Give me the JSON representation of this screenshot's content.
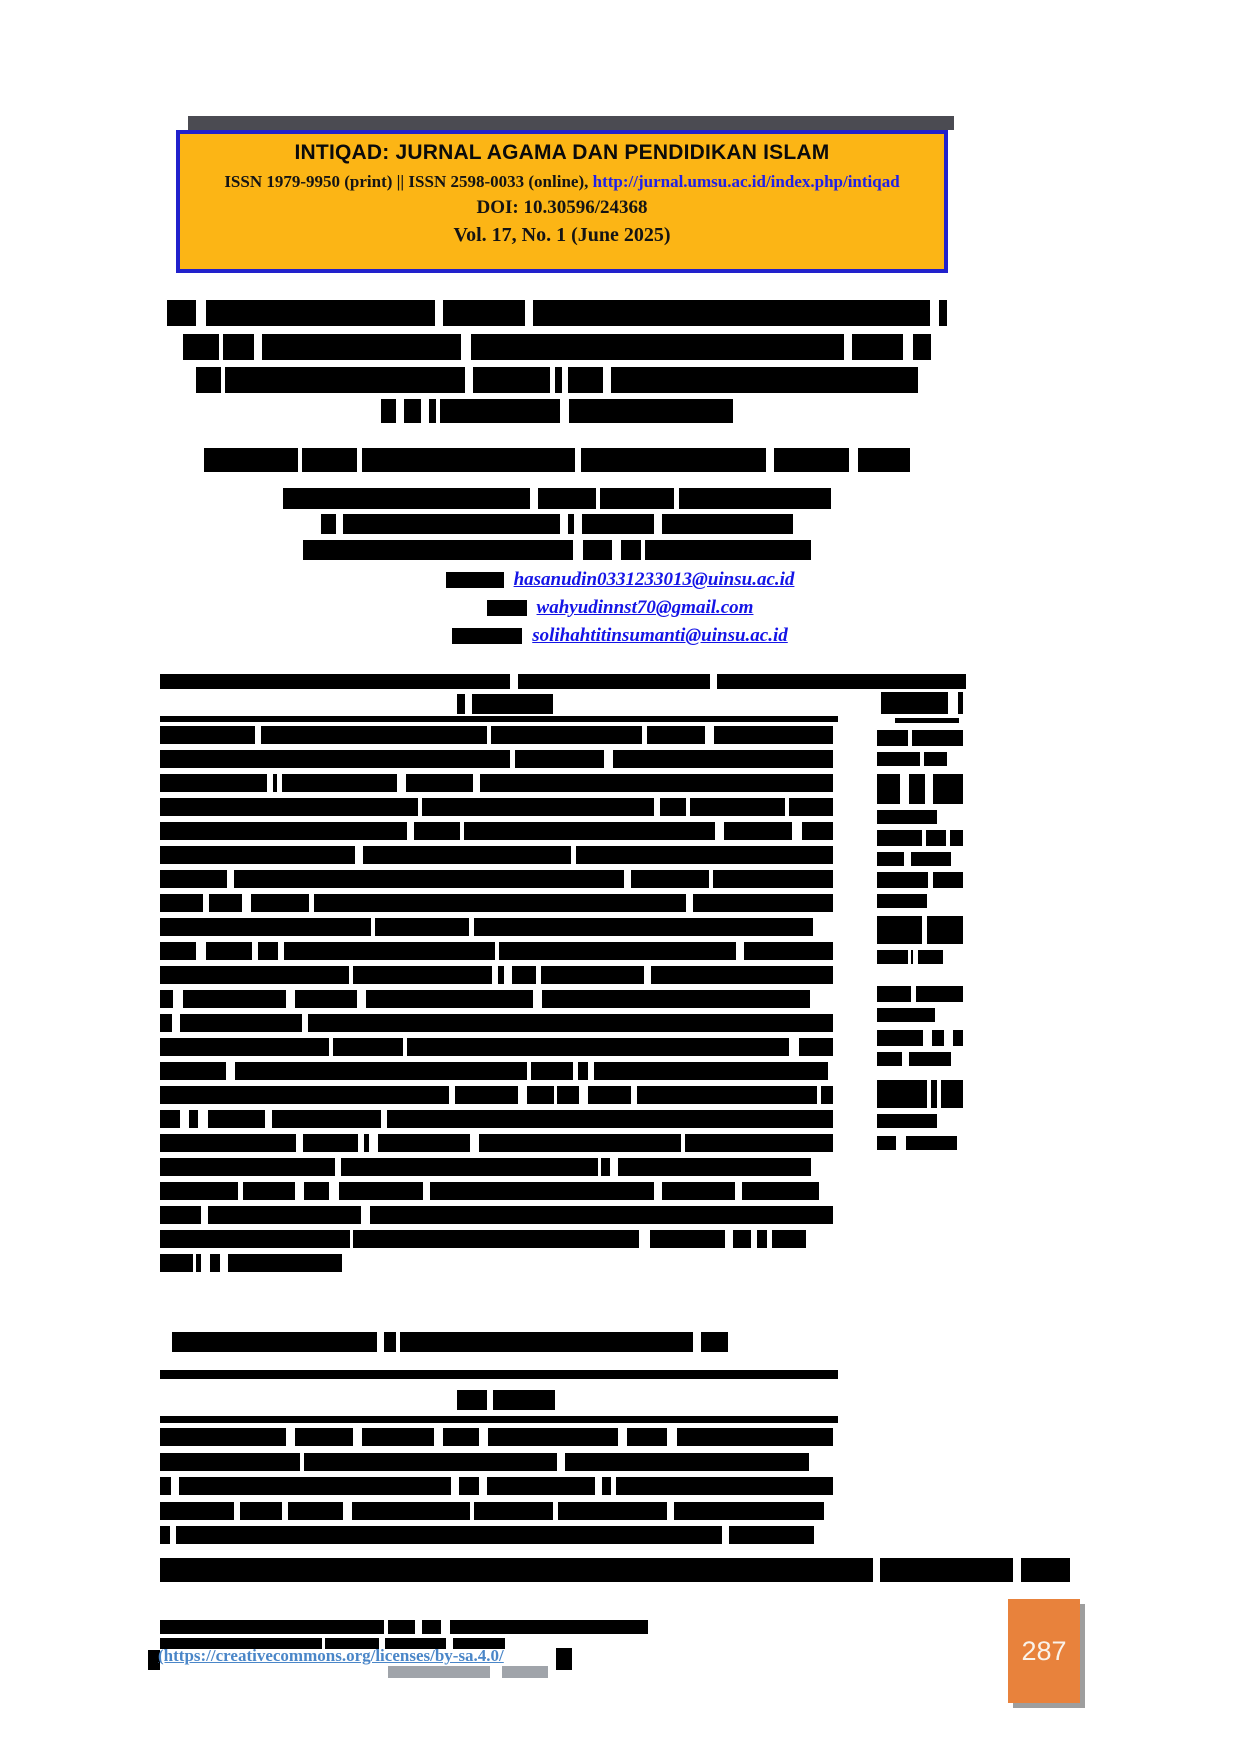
{
  "header_box": {
    "journal_title": "INTIQAD: JURNAL AGAMA DAN PENDIDIKAN ISLAM",
    "issn_text": "ISSN 1979-9950 (print) || ISSN 2598-0033 (online), ",
    "issn_link": "http://jurnal.umsu.ac.id/index.php/intiqad",
    "doi_line": "DOI: 10.30596/24368",
    "volume_line": "Vol. 17, No. 1 (June 2025)",
    "colors": {
      "bg": "#FCB515",
      "border": "#2121CC",
      "link": "#2020E8",
      "shadow": "#4B4B52"
    }
  },
  "emails": {
    "link_color": "#1414E6",
    "items": [
      {
        "prefix_bar_width": 58,
        "address": "hasanudin0331233013@uinsu.ac.id"
      },
      {
        "prefix_bar_width": 40,
        "address": "wahyudinnst70@gmail.com"
      },
      {
        "prefix_bar_width": 70,
        "address": "solihahtitinsumanti@uinsu.ac.id"
      }
    ]
  },
  "footer": {
    "license_link": "(https://creativecommons.org/licenses/by-sa.4.0/",
    "link_color": "#4A86C8"
  },
  "page_number": {
    "value": "287",
    "box_color": "#E8823C",
    "shadow_color": "#9E9E9E",
    "text_color": "#FAF3EA"
  },
  "redactions": {
    "seed": 20250617,
    "content_center_x": 557,
    "centered_lines": [
      {
        "y": 300,
        "w": 780,
        "h": 26,
        "name": "redacted-title-line"
      },
      {
        "y": 334,
        "w": 748,
        "h": 26,
        "name": "redacted-title-line"
      },
      {
        "y": 367,
        "w": 722,
        "h": 26,
        "name": "redacted-title-line"
      },
      {
        "y": 399,
        "w": 352,
        "h": 24,
        "name": "redacted-title-line"
      },
      {
        "y": 448,
        "w": 706,
        "h": 24,
        "name": "redacted-authors-line"
      },
      {
        "y": 488,
        "w": 548,
        "h": 21,
        "name": "redacted-affiliation-line"
      },
      {
        "y": 514,
        "w": 472,
        "h": 20,
        "name": "redacted-affiliation-line"
      },
      {
        "y": 540,
        "w": 508,
        "h": 20,
        "name": "redacted-affiliation-line"
      }
    ],
    "rules": [
      {
        "x": 160,
        "y": 674,
        "w": 806,
        "h": 15,
        "name": "table-top-rule"
      },
      {
        "x": 160,
        "y": 716,
        "w": 678,
        "h": 6,
        "name": "abstract-header-rule"
      },
      {
        "x": 160,
        "y": 1370,
        "w": 678,
        "h": 9,
        "name": "abstrak-top-rule"
      },
      {
        "x": 160,
        "y": 1416,
        "w": 678,
        "h": 7,
        "name": "abstrak-header-rule"
      },
      {
        "x": 160,
        "y": 1558,
        "w": 910,
        "h": 24,
        "name": "redacted-citation-line"
      }
    ],
    "headings": [
      {
        "x": 457,
        "y": 694,
        "w": 96,
        "h": 20,
        "name": "redacted-abstract-heading"
      },
      {
        "x": 457,
        "y": 1390,
        "w": 98,
        "h": 20,
        "name": "redacted-abstrak-heading"
      }
    ],
    "paragraphs": [
      {
        "x": 160,
        "y": 726,
        "w": 673,
        "lines": 23,
        "pitch": 24,
        "lh": 17.5,
        "last_w": 182,
        "name": "redacted-abstract-text"
      },
      {
        "x": 172,
        "y": 1332,
        "w": 556,
        "lines": 1,
        "pitch": 24,
        "lh": 20,
        "name": "redacted-keywords-line"
      },
      {
        "x": 160,
        "y": 1428,
        "w": 673,
        "lines": 5,
        "pitch": 24.5,
        "lh": 18,
        "name": "redacted-abstrak-text"
      },
      {
        "x": 160,
        "y": 1620,
        "w": 488,
        "lines": 1,
        "pitch": 18,
        "lh": 14,
        "name": "redacted-license-text"
      },
      {
        "x": 160,
        "y": 1638,
        "w": 372,
        "lines": 1,
        "pitch": 16,
        "lh": 11,
        "name": "redacted-license-text"
      }
    ],
    "sidebar": {
      "x": 877,
      "w": 88,
      "bars": [
        {
          "y": 692,
          "w": 82,
          "h": 22,
          "dx": 4
        },
        {
          "y": 718,
          "w": 64,
          "h": 5,
          "dx": 18
        },
        {
          "y": 730,
          "w": 86,
          "h": 16
        },
        {
          "y": 752,
          "w": 70,
          "h": 14
        },
        {
          "y": 774,
          "w": 86,
          "h": 30
        },
        {
          "y": 810,
          "w": 60,
          "h": 14
        },
        {
          "y": 830,
          "w": 86,
          "h": 16
        },
        {
          "y": 852,
          "w": 74,
          "h": 14
        },
        {
          "y": 872,
          "w": 86,
          "h": 16
        },
        {
          "y": 894,
          "w": 50,
          "h": 14
        },
        {
          "y": 916,
          "w": 86,
          "h": 28
        },
        {
          "y": 950,
          "w": 66,
          "h": 14
        },
        {
          "y": 986,
          "w": 86,
          "h": 16
        },
        {
          "y": 1008,
          "w": 58,
          "h": 14
        },
        {
          "y": 1030,
          "w": 86,
          "h": 16
        },
        {
          "y": 1052,
          "w": 74,
          "h": 14
        },
        {
          "y": 1080,
          "w": 86,
          "h": 28
        },
        {
          "y": 1114,
          "w": 60,
          "h": 14
        },
        {
          "y": 1136,
          "w": 80,
          "h": 14
        }
      ]
    },
    "fragments": [
      {
        "x": 148,
        "y": 1650,
        "w": 12,
        "h": 20,
        "color": "#000000",
        "name": "redacted-fragment"
      },
      {
        "x": 556,
        "y": 1648,
        "w": 16,
        "h": 22,
        "color": "#000000",
        "name": "redacted-fragment"
      },
      {
        "x": 388,
        "y": 1666,
        "w": 102,
        "h": 12,
        "color": "#A0A4AA",
        "name": "license-text-remnant"
      },
      {
        "x": 502,
        "y": 1666,
        "w": 46,
        "h": 12,
        "color": "#A0A4AA",
        "name": "license-text-remnant"
      }
    ]
  }
}
